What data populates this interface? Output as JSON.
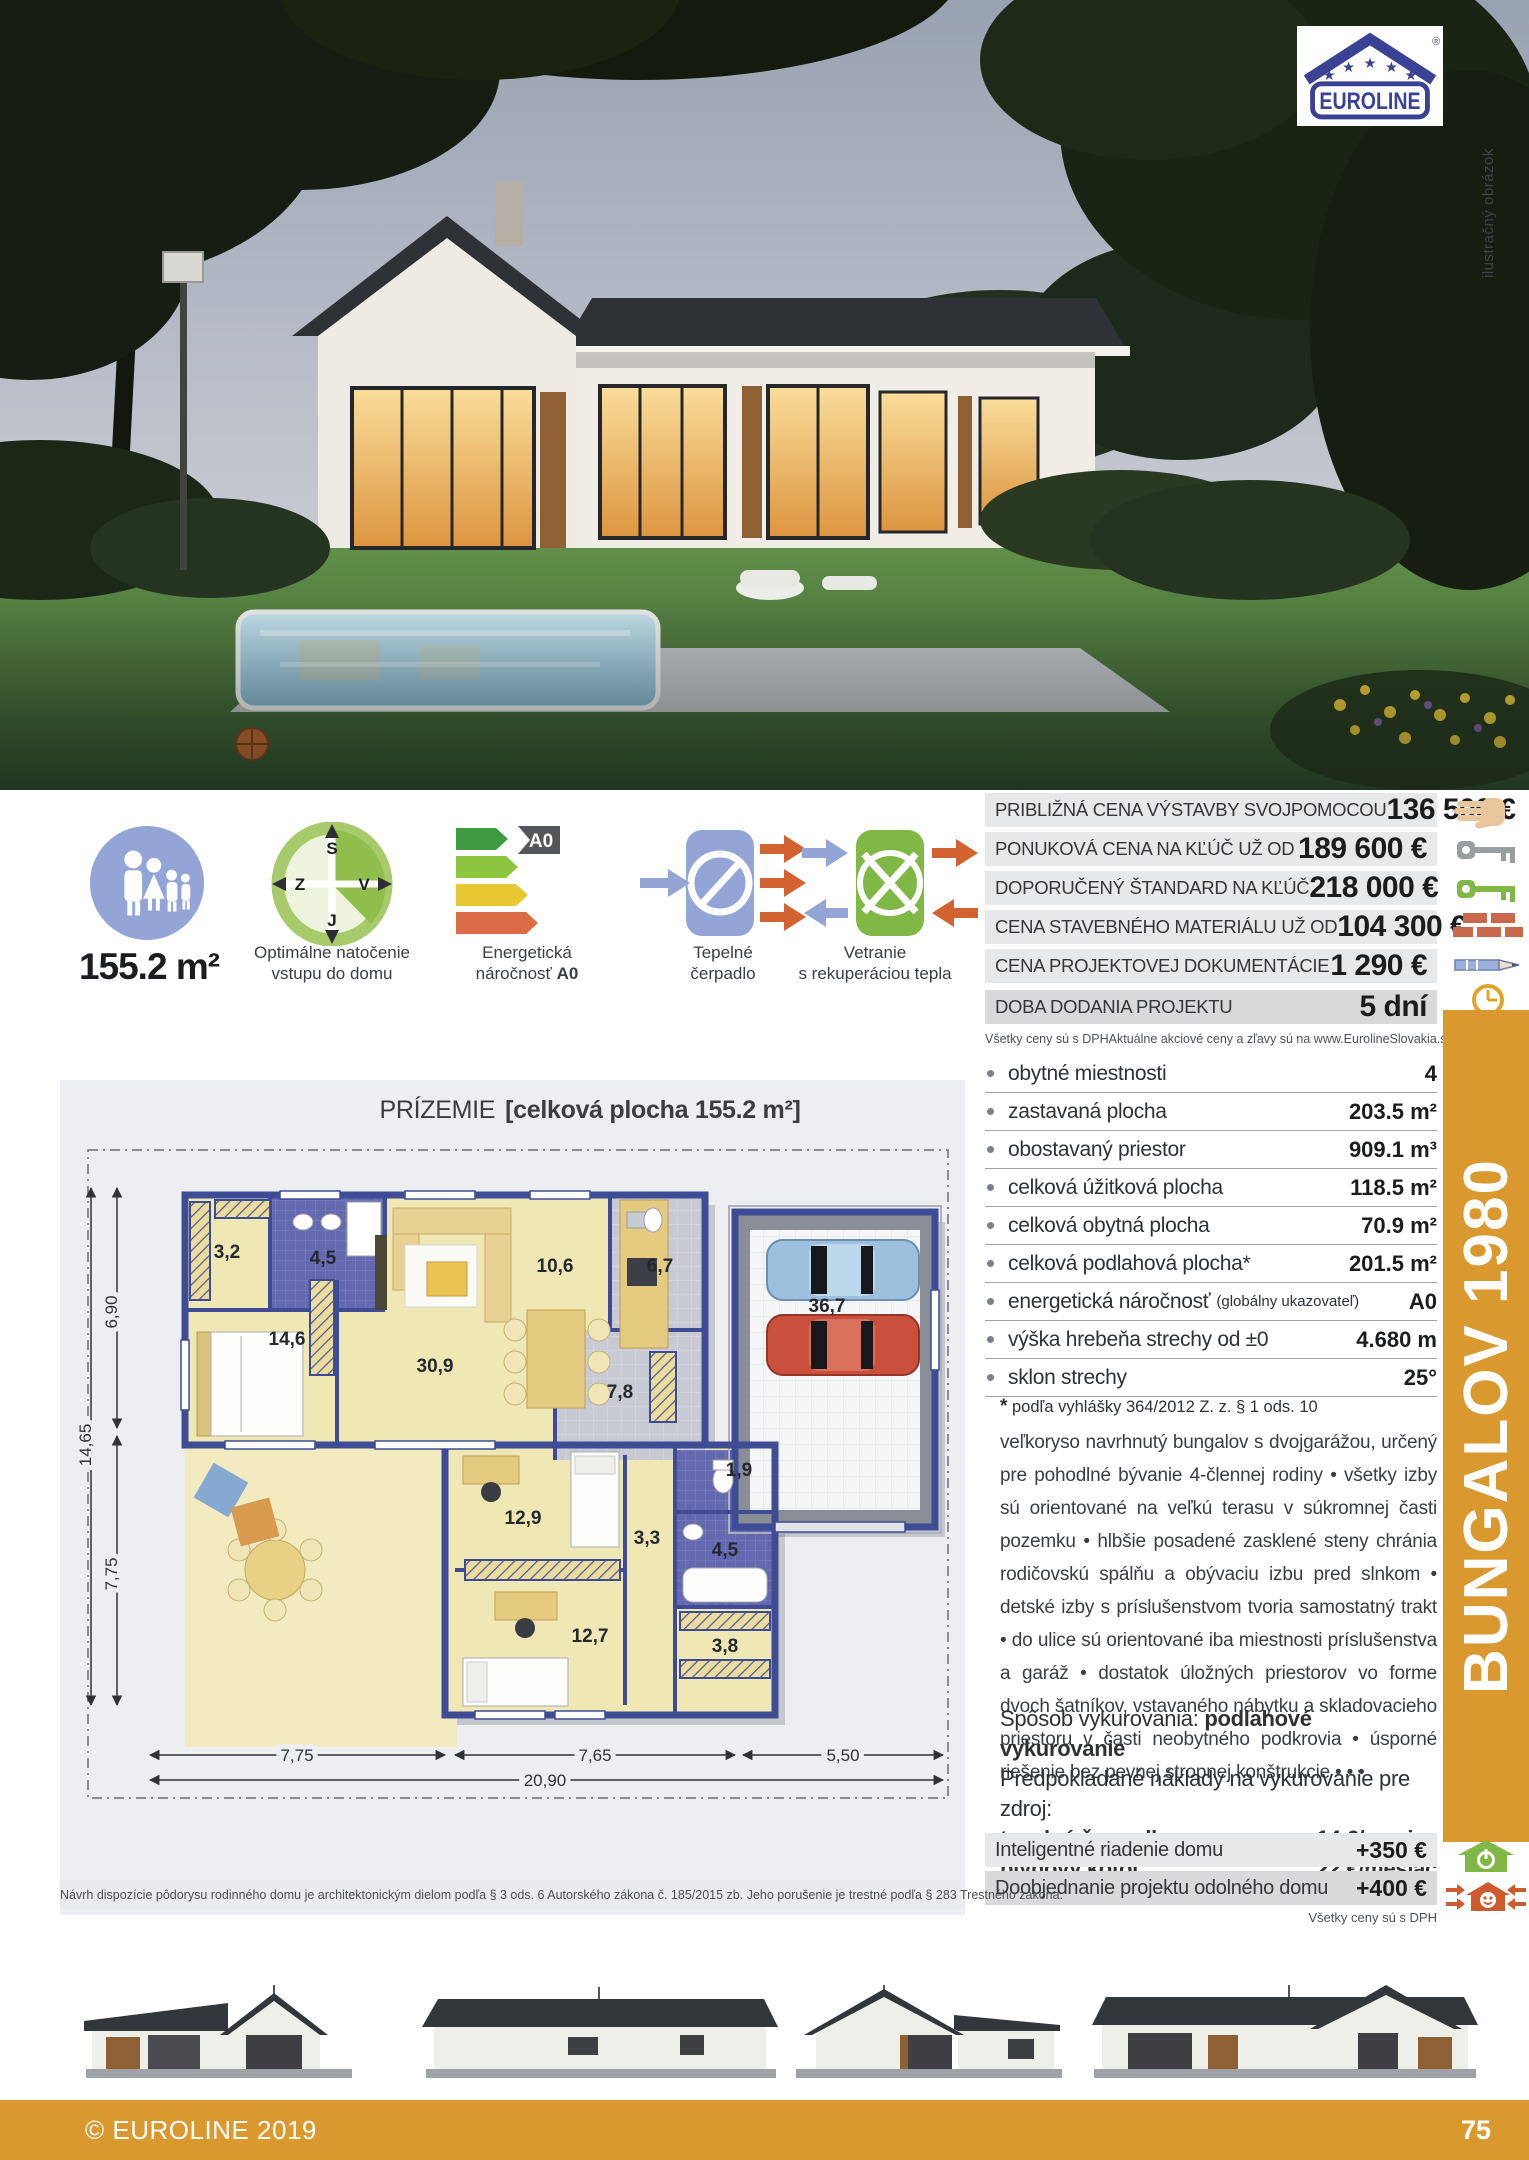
{
  "photo": {
    "note": "ilustračný obrázok"
  },
  "brand": {
    "name": "EUROLINE",
    "registered": "®"
  },
  "model": {
    "name": "BUNGALOV 1980"
  },
  "features": {
    "area": "155.2 m²",
    "orientation": {
      "line1": "Optimálne natočenie",
      "line2": "vstupu do domu",
      "n": "S",
      "w": "Z",
      "e": "V",
      "s": "J"
    },
    "energy": {
      "line1": "Energetická",
      "line2a": "náročnosť",
      "badge": "A0"
    },
    "heat_pump": {
      "line1": "Tepelné",
      "line2": "čerpadlo"
    },
    "ventilation": {
      "line1": "Vetranie",
      "line2": "s rekuperáciou tepla"
    }
  },
  "price_table": {
    "rows": [
      {
        "label": "PRIBLIŽNÁ CENA VÝSTAVBY SVOJPOMOCOU",
        "value": "136 500 €"
      },
      {
        "label": "PONUKOVÁ CENA NA KĽÚČ UŽ OD",
        "value": "189 600 €"
      },
      {
        "label": "DOPORUČENÝ ŠTANDARD NA KĽÚČ",
        "value": "218 000 €"
      },
      {
        "label": "CENA STAVEBNÉHO MATERIÁLU UŽ OD",
        "value": "104 300 €"
      },
      {
        "label": "CENA PROJEKTOVEJ DOKUMENTÁCIE",
        "value": "1 290 €"
      },
      {
        "label": "DOBA DODANIA PROJEKTU",
        "value": "5 dní"
      }
    ],
    "note_left": "Všetky ceny sú s DPH",
    "note_right": "Aktuálne akciové ceny a zľavy sú na www.EurolineSlovakia.sk"
  },
  "specs": {
    "rows": [
      {
        "label": "obytné miestnosti",
        "note": "",
        "value": "4"
      },
      {
        "label": "zastavaná plocha",
        "note": "",
        "value": "203.5 m²"
      },
      {
        "label": "obostavaný priestor",
        "note": "",
        "value": "909.1 m³"
      },
      {
        "label": "celková úžitková plocha",
        "note": "",
        "value": "118.5 m²"
      },
      {
        "label": "celková obytná plocha",
        "note": "",
        "value": "70.9 m²"
      },
      {
        "label": "celková podlahová plocha*",
        "note": "",
        "value": "201.5 m²"
      },
      {
        "label": "energetická náročnosť",
        "note": "(globálny ukazovateľ)",
        "value": "A0"
      },
      {
        "label": "výška hrebeňa strechy od ±0",
        "note": "",
        "value": "4.680 m"
      },
      {
        "label": "sklon strechy",
        "note": "",
        "value": "25°"
      }
    ],
    "footnote_star": "*",
    "footnote": "podľa vyhlášky 364/2012 Z. z. § 1 ods. 10"
  },
  "description": "veľkoryso navrhnutý bungalov s dvojgarážou, určený pre pohodlné bývanie 4-člennej rodiny • všetky izby sú orientované na veľkú terasu v súkromnej časti pozemku • hlbšie posadené zasklené steny chránia rodičovskú spálňu a obývaciu izbu pred slnkom • detské izby s príslušenstvom tvoria samostatný trakt • do ulice sú orientované iba miestnosti príslušenstva a garáž • dostatok úložných priestorov vo forme dvoch šatníkov, vstavaného nábytku a skladovacieho priestoru v časti neobytného podkrovia • úsporné riešenie bez pevnej stropnej konštrukcie • • •",
  "heating": {
    "method_label": "Spôsob vykurovania:",
    "method_value": "podlahové vykurovanie",
    "costs_intro": "Predpokladané náklady na vykurovanie pre zdroj:",
    "rows": [
      {
        "label": "tepelné čerpadlo",
        "value": "14 €/mesiac"
      },
      {
        "label": "plynový kotol",
        "value": "22 €/mesiac"
      }
    ]
  },
  "addons": {
    "rows": [
      {
        "label": "Inteligentné riadenie domu",
        "value": "+350 €"
      },
      {
        "label": "Doobjednanie projektu odolného domu",
        "value": "+400 €"
      }
    ],
    "note": "Všetky ceny sú s DPH"
  },
  "plan": {
    "title": "PRÍZEMIE",
    "subtitle": "[celková plocha 155.2 m²]",
    "rooms": {
      "wardrobe": "3,2",
      "bath1": "4,5",
      "bedroom": "14,6",
      "living": "30,9",
      "kitchen": "10,6",
      "hall1": "6,7",
      "hall2": "7,8",
      "garage": "36,7",
      "wc": "1,9",
      "kid1": "12,9",
      "hall3": "3,3",
      "bath2": "4,5",
      "kid2": "12,7",
      "storage": "3,8"
    },
    "dims": {
      "w1": "7,75",
      "w2": "7,65",
      "w3": "5,50",
      "w_total": "20,90",
      "h1": "6,90",
      "h2": "7,75",
      "h_total": "14,65"
    }
  },
  "disclaimer": "Návrh dispozície pôdorysu rodinného domu je architektonickým dielom podľa § 3 ods. 6 Autorského zákona č. 185/2015 zb. Jeho porušenie je trestné podľa § 283 Trestného zákona.",
  "footer": {
    "copyright": "© EUROLINE 2019",
    "page": "75"
  },
  "colors": {
    "accent": "#d9992f",
    "navy": "#3a4296",
    "wall": "#3d4c95",
    "energy_badge": "#55565a"
  }
}
